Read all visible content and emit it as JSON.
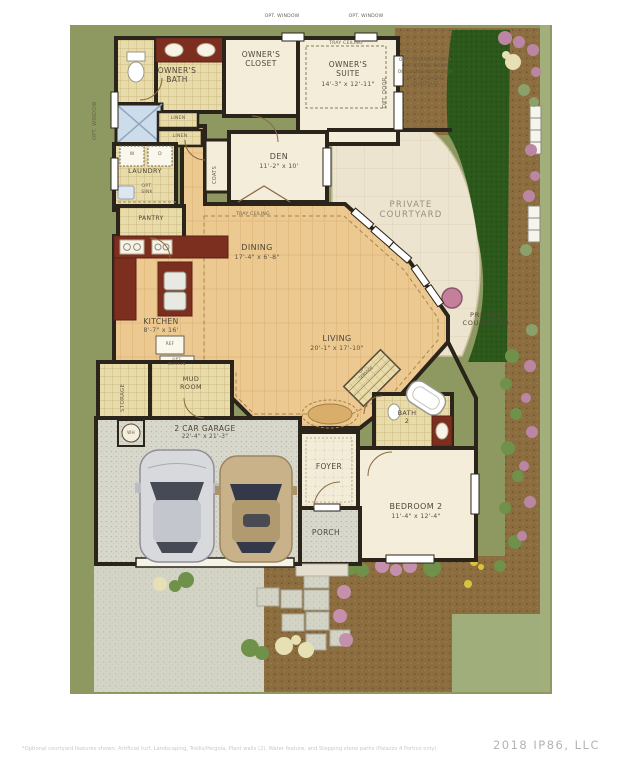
{
  "watermark": "2018 IP86, LLC",
  "disclaimer": "*Optional courtyard features shown: Artificial turf, Landscaping, Trellis/Pergola, Plant walls (2), Water feature, and Stepping stone paths (Palazzo 4 Portico only)",
  "rooms": {
    "owners_bath": {
      "label": "OWNER'S\nBATH"
    },
    "owners_closet": {
      "label": "OWNER'S\nCLOSET"
    },
    "owners_suite": {
      "label": "OWNER'S\nSUITE",
      "dims": "14'-3\" x 12'-11\""
    },
    "den": {
      "label": "DEN",
      "dims": "11'-2\" x 10'"
    },
    "laundry": {
      "label": "LAUNDRY"
    },
    "pantry": {
      "label": "PANTRY"
    },
    "dining": {
      "label": "DINING",
      "dims": "17'-4\" x 6'-8\""
    },
    "kitchen": {
      "label": "KITCHEN",
      "dims": "8'-7\" x 16'"
    },
    "living": {
      "label": "LIVING",
      "dims": "20'-1\" x 17'-10\""
    },
    "mud_room": {
      "label": "MUD\nROOM"
    },
    "storage": {
      "label": "STORAGE"
    },
    "garage": {
      "label": "2 CAR GARAGE",
      "dims": "22'-4\" x 21'-3\""
    },
    "foyer": {
      "label": "FOYER"
    },
    "porch": {
      "label": "PORCH"
    },
    "bath_2": {
      "label": "BATH\n2"
    },
    "bedroom_2": {
      "label": "BEDROOM 2",
      "dims": "11'-4\" x 12'-4\""
    },
    "private_courtyard": {
      "label": "PRIVATE\nCOURTYARD"
    },
    "private_courtyard_side": {
      "label": "PRIVATE\nCOURTYARD"
    }
  },
  "annotations": {
    "tray_ceiling_suite": "TRAY CEILING",
    "tray_ceiling_dining": "TRAY CEILING",
    "opt_window_left": "OPT. WINDOW",
    "opt_window_top_1": "OPT. WINDOW",
    "opt_window_top_2": "OPT. WINDOW",
    "opt_door": "OPT. DOOR",
    "linen_1": "LINEN",
    "linen_2": "LINEN",
    "coats": "COATS",
    "washer": "W",
    "dryer": "D",
    "opt_sink": "OPT.\nSINK",
    "ref": "REF",
    "opt_built_in": "OPT.\nBUILT-IN",
    "water_heater": "WH",
    "opt_service": "OPT.\nSERVICE",
    "courtyard_options": "OPT. COVERED PORCH\nOPT. SITTING ROOM\nOPT. SCREENED PORCH\nOPT. EXTENDED\nCOURTYARD"
  },
  "colors": {
    "background_olive": "#8d9960",
    "wall": "#2a241b",
    "wood_floor": "#ecc991",
    "tile_floor": "#e8dcab",
    "cabinet_red": "#7c2f1f",
    "courtyard_concrete": "#ece4cf",
    "turf_green": "#2c591b",
    "dirt_brown": "#8b6d3f"
  }
}
